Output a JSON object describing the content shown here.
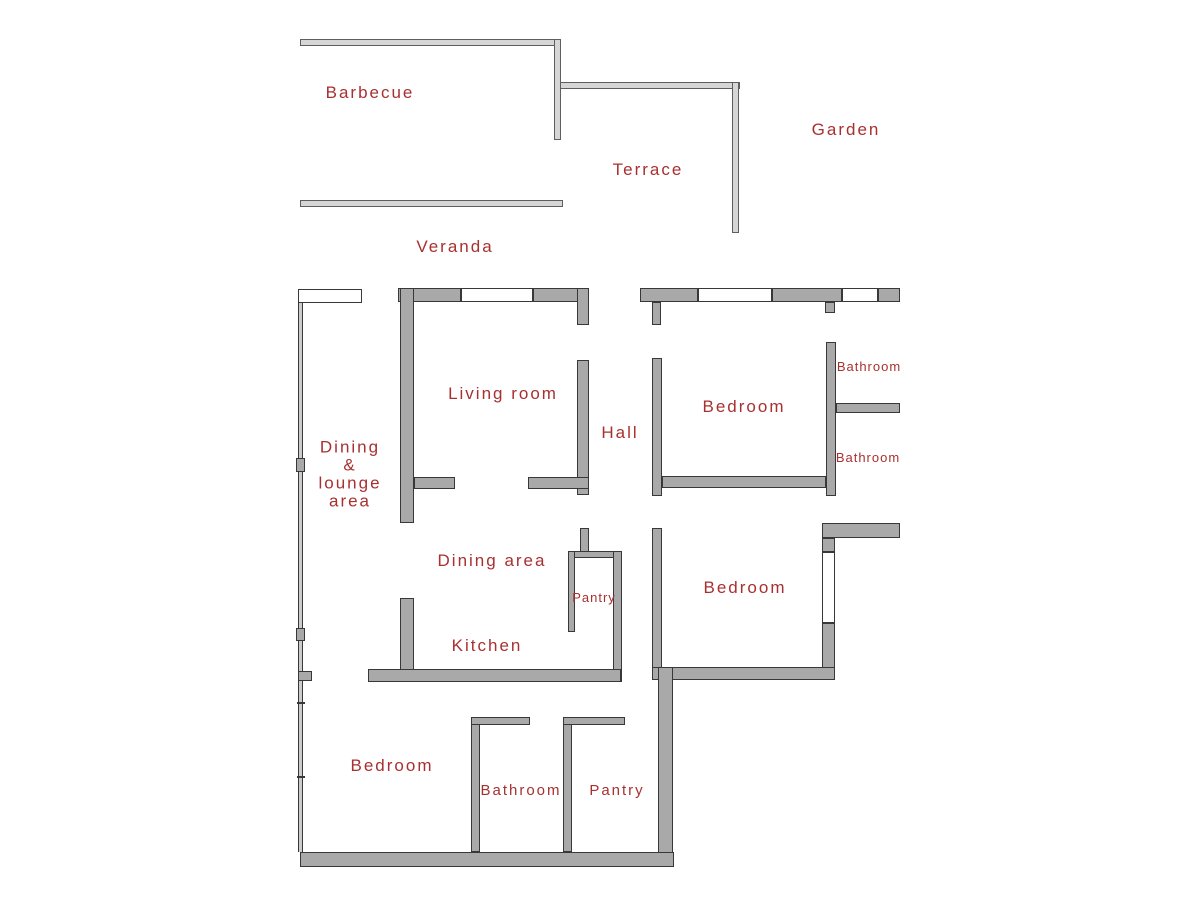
{
  "plan": {
    "width": 1200,
    "height": 900,
    "colors": {
      "background": "#ffffff",
      "wall_fill": "#a9a9a9",
      "wall_border": "#383838",
      "light_wall_fill": "#d6d6d6",
      "light_wall_border": "#5e5e5e",
      "thin_wall_fill": "#cccccc",
      "window_fill": "#ffffff",
      "label_color": "#a83030"
    },
    "rooms": [
      {
        "id": "barbecue",
        "label": "Barbecue",
        "x": 370,
        "y": 93,
        "size": 17
      },
      {
        "id": "garden",
        "label": "Garden",
        "x": 846,
        "y": 130,
        "size": 17
      },
      {
        "id": "terrace",
        "label": "Terrace",
        "x": 648,
        "y": 170,
        "size": 17
      },
      {
        "id": "veranda",
        "label": "Veranda",
        "x": 455,
        "y": 247,
        "size": 17
      },
      {
        "id": "living-room",
        "label": "Living room",
        "x": 503,
        "y": 394,
        "size": 17
      },
      {
        "id": "hall",
        "label": "Hall",
        "x": 620,
        "y": 433,
        "size": 17
      },
      {
        "id": "bedroom-top",
        "label": "Bedroom",
        "x": 744,
        "y": 407,
        "size": 17
      },
      {
        "id": "bathroom-top",
        "label": "Bathroom",
        "x": 869,
        "y": 367,
        "size": 13,
        "small": true
      },
      {
        "id": "bathroom-mid",
        "label": "Bathroom",
        "x": 868,
        "y": 458,
        "size": 13,
        "small": true
      },
      {
        "id": "dining-lounge",
        "label": "Dining & lounge area",
        "lines": [
          "Dining",
          "&",
          "lounge",
          "area"
        ],
        "x": 350,
        "y": 474,
        "size": 17
      },
      {
        "id": "dining-area",
        "label": "Dining area",
        "x": 492,
        "y": 561,
        "size": 17
      },
      {
        "id": "pantry-mid",
        "label": "Pantry",
        "x": 594,
        "y": 598,
        "size": 13,
        "small": true
      },
      {
        "id": "bedroom-mid",
        "label": "Bedroom",
        "x": 745,
        "y": 588,
        "size": 17
      },
      {
        "id": "kitchen",
        "label": "Kitchen",
        "x": 487,
        "y": 646,
        "size": 17
      },
      {
        "id": "bedroom-bottom",
        "label": "Bedroom",
        "x": 392,
        "y": 766,
        "size": 17
      },
      {
        "id": "bathroom-bottom",
        "label": "Bathroom",
        "x": 521,
        "y": 791,
        "size": 15
      },
      {
        "id": "pantry-bottom",
        "label": "Pantry",
        "x": 617,
        "y": 791,
        "size": 15
      }
    ],
    "walls": [
      {
        "id": "barbecue-top-wall",
        "type": "light",
        "x": 300,
        "y": 39,
        "w": 257,
        "h": 7
      },
      {
        "id": "barbecue-terrace-connector",
        "type": "light",
        "x": 554,
        "y": 39,
        "w": 7,
        "h": 101
      },
      {
        "id": "terrace-top-wall",
        "type": "light",
        "x": 560,
        "y": 82,
        "w": 180,
        "h": 7
      },
      {
        "id": "terrace-right-wall",
        "type": "light",
        "x": 732,
        "y": 82,
        "w": 7,
        "h": 151
      },
      {
        "id": "veranda-wall",
        "type": "light",
        "x": 300,
        "y": 200,
        "w": 263,
        "h": 7
      },
      {
        "id": "left-outer-wall",
        "type": "thin",
        "x": 298,
        "y": 289,
        "w": 5,
        "h": 563
      },
      {
        "id": "left-wall-post-1",
        "type": "block",
        "x": 296,
        "y": 458,
        "w": 9,
        "h": 14
      },
      {
        "id": "left-wall-post-2",
        "type": "block",
        "x": 296,
        "y": 628,
        "w": 9,
        "h": 13
      },
      {
        "id": "left-wall-stub",
        "type": "block",
        "x": 298,
        "y": 671,
        "w": 14,
        "h": 10
      },
      {
        "id": "left-wall-tick-1",
        "type": "tick",
        "x": 297,
        "y": 702,
        "w": 8,
        "h": 2
      },
      {
        "id": "left-wall-tick-2",
        "type": "tick",
        "x": 297,
        "y": 776,
        "w": 8,
        "h": 2
      },
      {
        "id": "top-wall-livingroom-left",
        "type": "thick",
        "x": 398,
        "y": 288,
        "w": 63,
        "h": 14
      },
      {
        "id": "top-wall-livingroom-right",
        "type": "thick",
        "x": 533,
        "y": 288,
        "w": 55,
        "h": 14
      },
      {
        "id": "top-wall-bedroom-1",
        "type": "thick",
        "x": 640,
        "y": 288,
        "w": 58,
        "h": 14
      },
      {
        "id": "top-wall-bedroom-2",
        "type": "thick",
        "x": 772,
        "y": 288,
        "w": 70,
        "h": 14
      },
      {
        "id": "top-wall-bedroom-3",
        "type": "thick",
        "x": 878,
        "y": 288,
        "w": 22,
        "h": 14
      },
      {
        "id": "livingroom-left-wall",
        "type": "thick",
        "x": 400,
        "y": 288,
        "w": 14,
        "h": 235
      },
      {
        "id": "livingroom-right-wall-upper",
        "type": "thick",
        "x": 577,
        "y": 288,
        "w": 12,
        "h": 37
      },
      {
        "id": "livingroom-right-wall-lower",
        "type": "thick",
        "x": 577,
        "y": 360,
        "w": 12,
        "h": 135
      },
      {
        "id": "livingroom-bottom-stub-left",
        "type": "thick",
        "x": 414,
        "y": 477,
        "w": 41,
        "h": 12
      },
      {
        "id": "livingroom-bottom-stub-right",
        "type": "thick",
        "x": 528,
        "y": 477,
        "w": 61,
        "h": 12
      },
      {
        "id": "hall-top-stub-left",
        "type": "thick",
        "x": 652,
        "y": 302,
        "w": 9,
        "h": 23
      },
      {
        "id": "hall-top-stub-right",
        "type": "thick",
        "x": 825,
        "y": 302,
        "w": 10,
        "h": 11
      },
      {
        "id": "bedroom-top-left-wall",
        "type": "thick",
        "x": 652,
        "y": 358,
        "w": 10,
        "h": 138
      },
      {
        "id": "bedroom-top-bottom-wall",
        "type": "thick",
        "x": 662,
        "y": 476,
        "w": 164,
        "h": 12
      },
      {
        "id": "bedroom-top-right-wall",
        "type": "thick",
        "x": 826,
        "y": 342,
        "w": 10,
        "h": 154
      },
      {
        "id": "bathrooms-divider-wall",
        "type": "thick",
        "x": 836,
        "y": 403,
        "w": 64,
        "h": 10
      },
      {
        "id": "bedroom-mid-top-wall",
        "type": "thick",
        "x": 822,
        "y": 523,
        "w": 78,
        "h": 15
      },
      {
        "id": "bedroom-mid-right-wall-upper",
        "type": "thick",
        "x": 822,
        "y": 538,
        "w": 13,
        "h": 14
      },
      {
        "id": "bedroom-mid-right-wall-lower",
        "type": "thick",
        "x": 822,
        "y": 623,
        "w": 13,
        "h": 57
      },
      {
        "id": "bedroom-mid-left-wall",
        "type": "thick",
        "x": 652,
        "y": 528,
        "w": 10,
        "h": 152
      },
      {
        "id": "bedroom-mid-bottom-wall",
        "type": "thick",
        "x": 652,
        "y": 667,
        "w": 183,
        "h": 13
      },
      {
        "id": "pantry-mid-door-stub",
        "type": "thick",
        "x": 580,
        "y": 528,
        "w": 9,
        "h": 25
      },
      {
        "id": "pantry-mid-top-wall",
        "type": "thick",
        "x": 568,
        "y": 551,
        "w": 52,
        "h": 7
      },
      {
        "id": "pantry-mid-left-wall",
        "type": "thick",
        "x": 568,
        "y": 551,
        "w": 7,
        "h": 81
      },
      {
        "id": "pantry-mid-right-wall",
        "type": "thick",
        "x": 613,
        "y": 551,
        "w": 9,
        "h": 131
      },
      {
        "id": "kitchen-left-wall",
        "type": "thick",
        "x": 400,
        "y": 598,
        "w": 14,
        "h": 84
      },
      {
        "id": "kitchen-bottom-wall",
        "type": "thick",
        "x": 368,
        "y": 669,
        "w": 253,
        "h": 13
      },
      {
        "id": "hall-lower-wall",
        "type": "thick",
        "x": 658,
        "y": 667,
        "w": 15,
        "h": 200
      },
      {
        "id": "bottom-outer-wall",
        "type": "thick",
        "x": 300,
        "y": 852,
        "w": 374,
        "h": 15
      },
      {
        "id": "bathroom-bottom-left-wall",
        "type": "thick",
        "x": 471,
        "y": 717,
        "w": 9,
        "h": 135
      },
      {
        "id": "bathroom-bottom-top-stub",
        "type": "thick",
        "x": 471,
        "y": 717,
        "w": 59,
        "h": 8
      },
      {
        "id": "pantry-bottom-left-wall",
        "type": "thick",
        "x": 563,
        "y": 717,
        "w": 9,
        "h": 135
      },
      {
        "id": "pantry-bottom-top-stub",
        "type": "thick",
        "x": 563,
        "y": 717,
        "w": 62,
        "h": 8
      },
      {
        "id": "window-veranda-door",
        "type": "window",
        "x": 298,
        "y": 289,
        "w": 64,
        "h": 14
      },
      {
        "id": "window-livingroom",
        "type": "window",
        "x": 461,
        "y": 288,
        "w": 72,
        "h": 14
      },
      {
        "id": "window-bedroom-top-1",
        "type": "window",
        "x": 698,
        "y": 288,
        "w": 74,
        "h": 14
      },
      {
        "id": "window-bedroom-top-2",
        "type": "window",
        "x": 842,
        "y": 288,
        "w": 36,
        "h": 14
      },
      {
        "id": "window-bedroom-mid",
        "type": "window",
        "x": 822,
        "y": 552,
        "w": 13,
        "h": 71
      }
    ]
  }
}
